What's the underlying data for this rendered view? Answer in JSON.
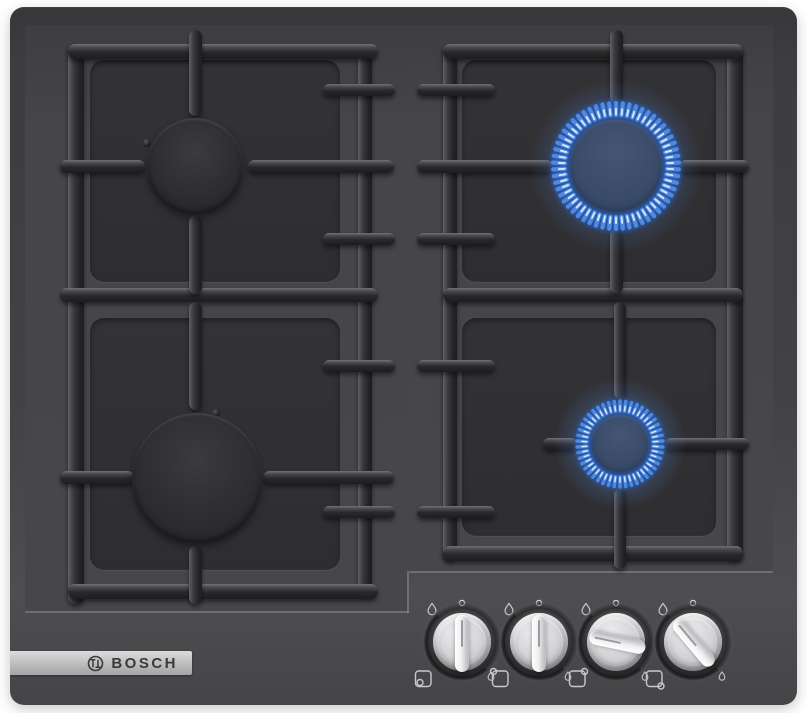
{
  "badge": {
    "label": "BOSCH"
  },
  "colors": {
    "flame_main": "#4f8fe8",
    "flame_glow": "#2a5ec4",
    "flame_core": "#ddefff",
    "knob_metal": "#d9d9dc",
    "surface": "#454548",
    "badge_bg": "#bcbcbe"
  },
  "burners": [
    {
      "id": "back-left",
      "cx": 195,
      "cy": 166,
      "cap_r": 48,
      "lit": false
    },
    {
      "id": "front-left",
      "cx": 197,
      "cy": 478,
      "cap_r": 65,
      "lit": false
    },
    {
      "id": "back-right",
      "cx": 616,
      "cy": 166,
      "cap_r": 46,
      "lit": true,
      "flame_inner_r": 50,
      "flame_outer_r": 63,
      "flame_count": 58,
      "tick_w": 4.2
    },
    {
      "id": "front-right",
      "cx": 620,
      "cy": 444,
      "cap_r": 29,
      "lit": true,
      "flame_inner_r": 32,
      "flame_outer_r": 43,
      "flame_count": 46,
      "tick_w": 3.4
    }
  ],
  "knobs": [
    {
      "id": "front-left",
      "cx": 462,
      "cy": 642,
      "rotation": 0,
      "dot_corner": "bottom-left"
    },
    {
      "id": "back-left",
      "cx": 539,
      "cy": 642,
      "rotation": 0,
      "dot_corner": "top-left"
    },
    {
      "id": "back-right",
      "cx": 616,
      "cy": 642,
      "rotation": -78,
      "dot_corner": "top-right"
    },
    {
      "id": "front-right",
      "cx": 693,
      "cy": 642,
      "rotation": -40,
      "dot_corner": "bottom-right"
    }
  ]
}
